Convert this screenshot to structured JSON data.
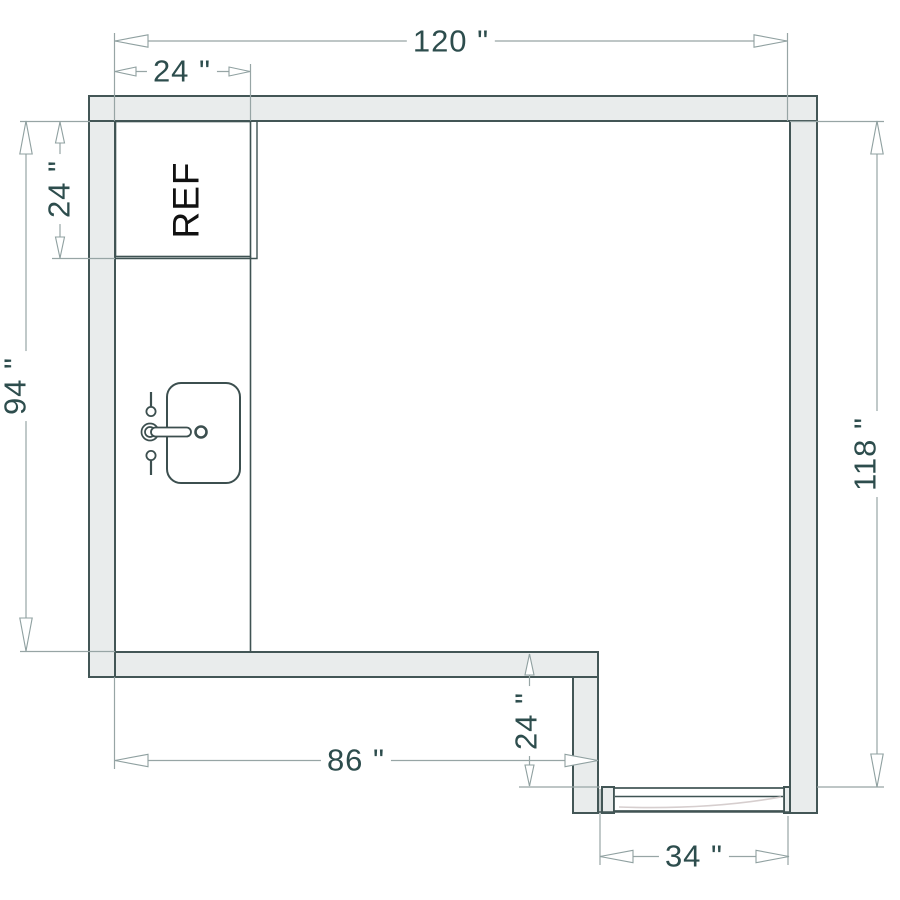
{
  "title": "Kitchen floor plan with dimensions",
  "labels": {
    "refrigerator": "REF"
  },
  "dimensions": {
    "width_total": {
      "label": "120 \"",
      "value": 120,
      "unit": "in"
    },
    "counter_depth_top": {
      "label": "24 \"",
      "value": 24,
      "unit": "in"
    },
    "fridge_height_left": {
      "label": "24 \"",
      "value": 24,
      "unit": "in"
    },
    "height_left": {
      "label": "94 \"",
      "value": 94,
      "unit": "in"
    },
    "height_right": {
      "label": "118 \"",
      "value": 118,
      "unit": "in"
    },
    "width_bottom_left": {
      "label": "86 \"",
      "value": 86,
      "unit": "in"
    },
    "step_depth": {
      "label": "24 \"",
      "value": 24,
      "unit": "in"
    },
    "door_width": {
      "label": "34 \"",
      "value": 34,
      "unit": "in"
    }
  },
  "fixtures": [
    "refrigerator",
    "sink",
    "counter-edge",
    "door"
  ],
  "colors": {
    "background": "#ffffff",
    "wall_fill": "#e9ecec",
    "wall_line": "#435656",
    "fixture_line": "#3f5353",
    "dim_line": "#97a5a5",
    "dim_text": "#2d4d4d",
    "ref_text": "#111111",
    "door_arc": "#d6cece"
  }
}
